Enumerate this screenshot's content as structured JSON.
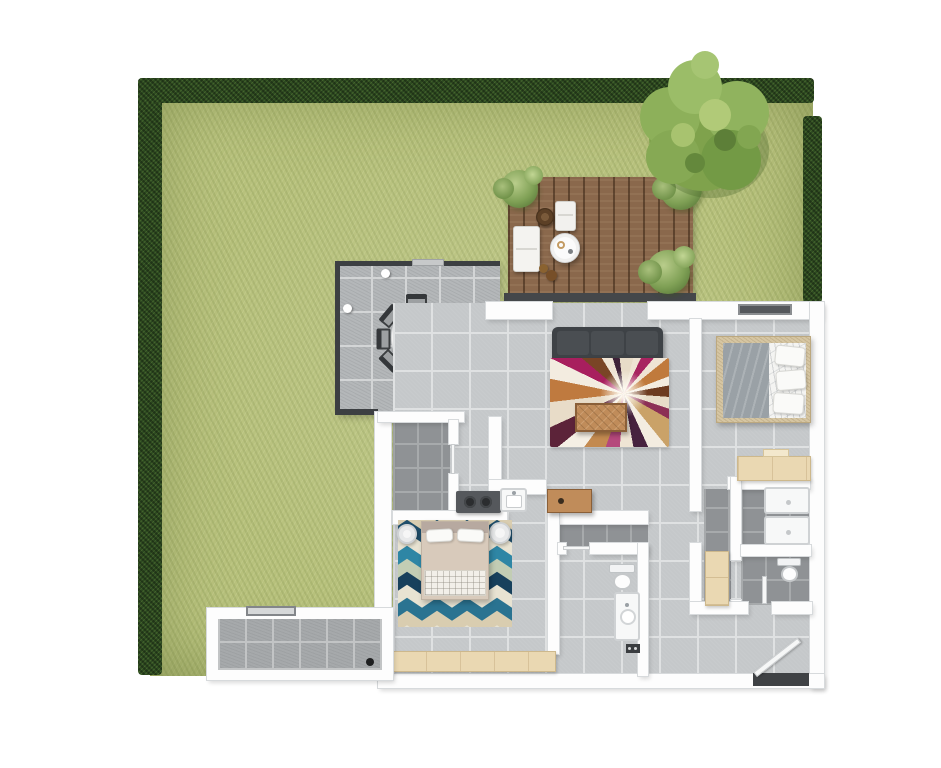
{
  "title": "apartment-floor-plan-top-view",
  "palette": {
    "grass": "#b7c17c",
    "hedge": "#2d4a21",
    "tree": "#85a855",
    "deck": "#8a684c",
    "tile_light": "#c5c8ca",
    "tile_patio": "#b4b7b9",
    "tile_dark": "#8f9295",
    "wall": "#fdfdfd",
    "fence": "#3c3f42",
    "sofa": "#3e4246",
    "wood": "#c08c5a",
    "dresser": "#ead8b2",
    "bedframe": "#d6c6a3",
    "bedgray": "#9aa1a6",
    "fixture": "#f7f8f8",
    "rug_living_accent": "#a81f5e",
    "rug_bedroom_blue": "#1f4e6b",
    "rug_bedroom_teal": "#2e86a5"
  },
  "scene": {
    "garden": {
      "hedge_sides": [
        "left",
        "top",
        "right"
      ],
      "tree_count": 1,
      "deck_plant_count": 3
    },
    "deck": {
      "furniture": [
        "outdoor-sofa",
        "rattan-chair",
        "lounge-chair",
        "round-table",
        "side-stools"
      ]
    },
    "patio": {
      "dining_chair_count": 8,
      "table_shape": "oval",
      "light_dot_count": 2
    },
    "living_room": {
      "furniture": [
        "sofa",
        "abstract-rug",
        "coffee-table",
        "sideboard"
      ]
    },
    "kitchen": {
      "features": [
        "cooktop-2-burner",
        "sink-counter"
      ]
    },
    "bedroom_right": {
      "furniture": [
        "double-bed",
        "dresser"
      ],
      "window_count": 1
    },
    "bedroom_master": {
      "furniture": [
        "double-bed",
        "nightstand",
        "nightstand",
        "chevron-rug",
        "long-dresser"
      ]
    },
    "bathroom_main": {
      "fixtures": [
        "toilet",
        "vanity-sink",
        "bath-mat"
      ]
    },
    "bathroom_second": {
      "fixtures": [
        "shower-tray",
        "shower-tray",
        "toilet"
      ]
    },
    "closet": {
      "furniture": [
        "tall-cabinet"
      ]
    },
    "entrance": {
      "features": [
        "entry-door-open",
        "dark-threshold"
      ]
    },
    "annex": {
      "features": [
        "window",
        "floor-drain"
      ]
    }
  }
}
